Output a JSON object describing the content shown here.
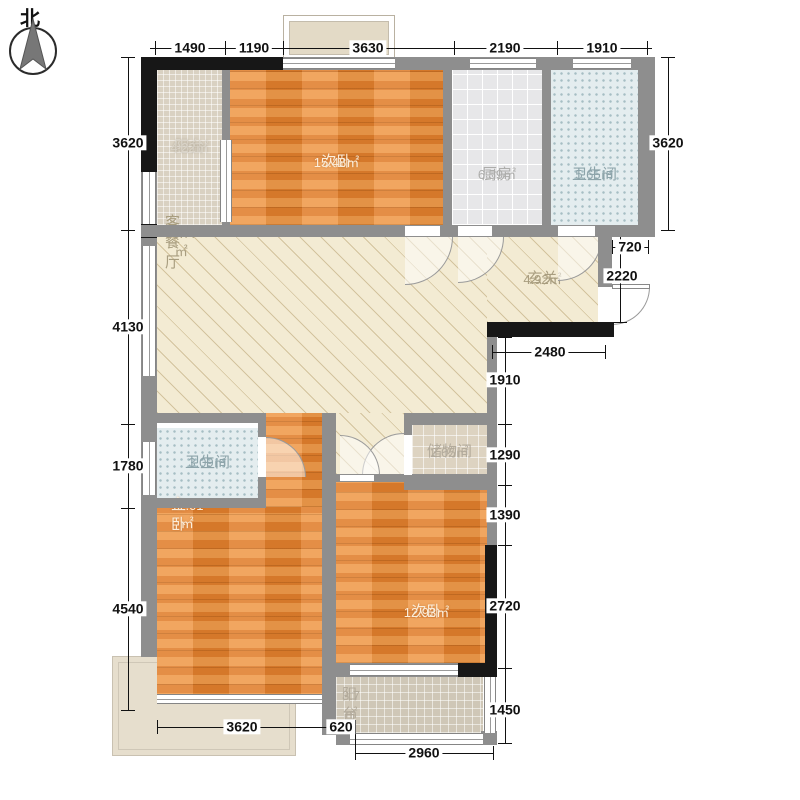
{
  "compass": {
    "north_label": "北"
  },
  "rooms": {
    "balcony_top": {
      "name": "阳台",
      "area": "4.22㎡"
    },
    "bedroom_top": {
      "name": "次卧",
      "area": "15.48㎡"
    },
    "kitchen": {
      "name": "厨房",
      "area": "6.59㎡"
    },
    "bath_top": {
      "name": "卫生间",
      "area": "5.65㎡"
    },
    "living": {
      "name": "客餐厅",
      "area": "33.77㎡"
    },
    "entry": {
      "name": "玄关",
      "area": "4.92㎡"
    },
    "bath_mid": {
      "name": "卫生间",
      "area": "3.09㎡"
    },
    "storage": {
      "name": "储物间",
      "area": "2.05㎡"
    },
    "master": {
      "name": "主卧",
      "area": "17.01㎡"
    },
    "bedroom_bottom": {
      "name": "次卧",
      "area": "12.93㎡"
    },
    "balcony_bottom": {
      "name": "阳台",
      "area": "3.7㎡"
    }
  },
  "dimensions": {
    "top": [
      "1490",
      "1190",
      "3630",
      "2190",
      "1910"
    ],
    "left": [
      "3620",
      "4130",
      "1780",
      "4540"
    ],
    "right_top": [
      "3620"
    ],
    "upper_right": [
      "720",
      "2220"
    ],
    "entry_bottom": [
      "2480"
    ],
    "right_inner": [
      "1910",
      "1290",
      "1390",
      "2720",
      "1450"
    ],
    "bottom": [
      "3620",
      "620",
      "2960"
    ]
  },
  "colors": {
    "wall": "#8e8e8e",
    "wall_dark": "#171717",
    "wood_floor": "#e9893b",
    "living_floor": "#f3ebd3",
    "kitchen_tile": "#e7e7e9",
    "bath_tile": "#e4edef",
    "balcony_tile": "#d9d1c2",
    "dim_text": "#111111"
  }
}
